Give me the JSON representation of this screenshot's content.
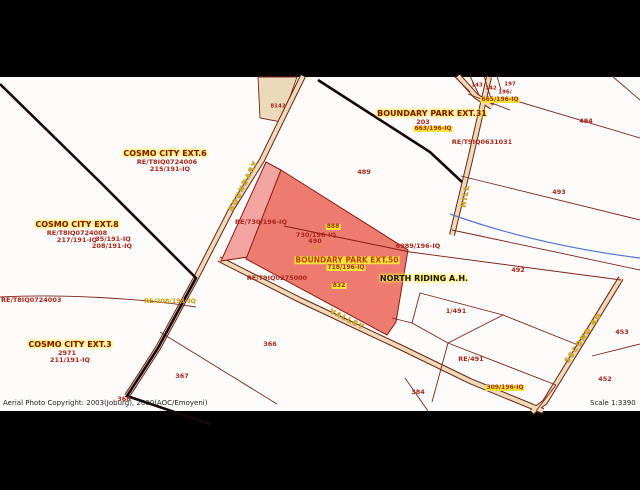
{
  "footer": {
    "copyright": "Aerial Photo Copyright:  2003(Joburg),  2000(AOC/Emoyeni)",
    "scale": "Scale 1:3390"
  },
  "colors": {
    "frame": "#000000",
    "map_bg": "#fdfcfa",
    "parcel_line": "#7b241c",
    "thick_boundary": "#16080a",
    "road_fill": "#eddbb8",
    "road_edge": "#6e1f16",
    "parcel_highlight": "#ee7b70",
    "parcel_highlight_light": "#f2a4a0",
    "parcel_tan": "#ecd9ba",
    "stream": "#5577cc",
    "label_red": "#a8261a",
    "label_highlight_bg": "#f6e23c",
    "street_yellow": "#d6b41c"
  },
  "map": {
    "labels": [
      {
        "n": "suburb-label-cosmo-city-ext6",
        "t": "COSMO CITY EXT.6",
        "x": 165,
        "y": 154,
        "c": "suburb"
      },
      {
        "n": "deed-label-re-t8iq0724006",
        "t": "RE/T8IQ0724006",
        "x": 167,
        "y": 162,
        "c": "red"
      },
      {
        "n": "portion-label-215-191-iq",
        "t": "215/191-IQ",
        "x": 170,
        "y": 169,
        "c": "red"
      },
      {
        "n": "suburb-label-cosmo-city-ext8",
        "t": "COSMO CITY EXT.8",
        "x": 77,
        "y": 225,
        "c": "suburb"
      },
      {
        "n": "deed-label-re-t8iq0724008",
        "t": "RE/T8IQ0724008",
        "x": 77,
        "y": 233,
        "c": "red"
      },
      {
        "n": "portion-label-217-191-iq",
        "t": "217/191-IQ",
        "x": 77,
        "y": 240,
        "c": "red"
      },
      {
        "n": "portion-label-35-191-iq",
        "t": "35/191-IQ",
        "x": 113,
        "y": 239,
        "c": "red"
      },
      {
        "n": "portion-label-208-191-iq",
        "t": "208/191-IQ",
        "x": 112,
        "y": 246,
        "c": "red"
      },
      {
        "n": "deed-label-re-t8iq0724003",
        "t": "RE/T8IQ0724003",
        "x": 1,
        "y": 300,
        "c": "red",
        "a": "left"
      },
      {
        "n": "suburb-label-cosmo-city-ext3",
        "t": "COSMO CITY EXT.3",
        "x": 70,
        "y": 345,
        "c": "suburb"
      },
      {
        "n": "erf-label-2971",
        "t": "2971",
        "x": 67,
        "y": 353,
        "c": "red"
      },
      {
        "n": "portion-label-211-191-iq",
        "t": "211/191-IQ",
        "x": 70,
        "y": 360,
        "c": "red"
      },
      {
        "n": "portion-label-re-208-191-iq",
        "t": "RE/208/191-IQ",
        "x": 170,
        "y": 301,
        "c": "yellow"
      },
      {
        "n": "erf-label-368",
        "t": "368",
        "x": 124,
        "y": 399,
        "c": "red"
      },
      {
        "n": "erf-label-367",
        "t": "367",
        "x": 182,
        "y": 376,
        "c": "red"
      },
      {
        "n": "erf-label-366",
        "t": "366",
        "x": 270,
        "y": 344,
        "c": "red"
      },
      {
        "n": "erf-label-8142",
        "t": "8142",
        "x": 278,
        "y": 107,
        "c": "red tiny"
      },
      {
        "n": "suburb-label-boundary-park-ext31",
        "t": "BOUNDARY PARK EXT.31",
        "x": 432,
        "y": 114,
        "c": "suburb"
      },
      {
        "n": "erf-label-203",
        "t": "203",
        "x": 423,
        "y": 122,
        "c": "red"
      },
      {
        "n": "portion-label-663-196-iq",
        "t": "663/196-IQ",
        "x": 433,
        "y": 129,
        "c": "hl"
      },
      {
        "n": "deed-label-re-t9iq0631031",
        "t": "RE/T9IQ0631031",
        "x": 482,
        "y": 142,
        "c": "red"
      },
      {
        "n": "erf-label-143",
        "t": "143",
        "x": 477,
        "y": 86,
        "c": "red tiny"
      },
      {
        "n": "erf-label-142",
        "t": "142",
        "x": 491,
        "y": 89,
        "c": "red tiny"
      },
      {
        "n": "erf-label-197",
        "t": "197",
        "x": 510,
        "y": 85,
        "c": "red tiny"
      },
      {
        "n": "erf-label-196",
        "t": "196/",
        "x": 505,
        "y": 93,
        "c": "red tiny"
      },
      {
        "n": "portion-label-665-196-iq",
        "t": "665/196-IQ",
        "x": 500,
        "y": 100,
        "c": "hl tiny"
      },
      {
        "n": "erf-label-489",
        "t": "489",
        "x": 364,
        "y": 172,
        "c": "red"
      },
      {
        "n": "erf-label-494",
        "t": "494",
        "x": 586,
        "y": 121,
        "c": "red"
      },
      {
        "n": "erf-label-493",
        "t": "493",
        "x": 559,
        "y": 192,
        "c": "red"
      },
      {
        "n": "erf-label-492",
        "t": "492",
        "x": 518,
        "y": 270,
        "c": "red"
      },
      {
        "n": "erf-label-453",
        "t": "453",
        "x": 622,
        "y": 332,
        "c": "red"
      },
      {
        "n": "erf-label-452",
        "t": "452",
        "x": 605,
        "y": 379,
        "c": "red"
      },
      {
        "n": "portion-label-re-730-196-iq",
        "t": "RE/730/196-IQ",
        "x": 261,
        "y": 222,
        "c": "red"
      },
      {
        "n": "portion-label-888",
        "t": "888",
        "x": 333,
        "y": 227,
        "c": "hl tiny"
      },
      {
        "n": "portion-label-730-196-iq",
        "t": "730/196-IQ",
        "x": 316,
        "y": 235,
        "c": "red"
      },
      {
        "n": "erf-label-490",
        "t": "490",
        "x": 315,
        "y": 241,
        "c": "red"
      },
      {
        "n": "portion-label-c",
        "t": "'C'",
        "x": 317,
        "y": 248,
        "c": "yellow"
      },
      {
        "n": "suburb-label-boundary-park-ext50",
        "t": "BOUNDARY PARK EXT.50",
        "x": 347,
        "y": 260,
        "c": "hl-big"
      },
      {
        "n": "portion-label-718-196-iq",
        "t": "718/196-IQ",
        "x": 346,
        "y": 268,
        "c": "hl"
      },
      {
        "n": "portion-label-6989-196-iq",
        "t": "6989/196-IQ",
        "x": 418,
        "y": 246,
        "c": "red"
      },
      {
        "n": "deed-label-re-t9iq0275000",
        "t": "RE/T9IQ0275000",
        "x": 277,
        "y": 278,
        "c": "red"
      },
      {
        "n": "portion-label-832",
        "t": "832",
        "x": 339,
        "y": 286,
        "c": "hl tiny"
      },
      {
        "n": "suburb-label-north-riding-ah",
        "t": "NORTH RIDING A.H.",
        "x": 424,
        "y": 279,
        "c": "suburb-dark"
      },
      {
        "n": "erf-label-1-491",
        "t": "1/491",
        "x": 456,
        "y": 311,
        "c": "red"
      },
      {
        "n": "erf-label-re-491",
        "t": "RE/491",
        "x": 471,
        "y": 359,
        "c": "red"
      },
      {
        "n": "portion-label-309-196-iq",
        "t": "309/196-IQ",
        "x": 505,
        "y": 388,
        "c": "hl"
      },
      {
        "n": "erf-label-384",
        "t": "384",
        "x": 418,
        "y": 392,
        "c": "red"
      },
      {
        "n": "street-name-boundary",
        "t": "BOUNDARY",
        "x": 244,
        "y": 186,
        "c": "street",
        "r": -63
      },
      {
        "n": "street-name-valley",
        "t": "VALLEY",
        "x": 347,
        "y": 320,
        "c": "street",
        "r": 27
      },
      {
        "n": "street-name-hill",
        "t": "HILL",
        "x": 466,
        "y": 196,
        "c": "street",
        "r": -80
      },
      {
        "n": "street-name-second-rd",
        "t": "SECOND RD",
        "x": 584,
        "y": 338,
        "c": "street",
        "r": -55
      }
    ]
  }
}
